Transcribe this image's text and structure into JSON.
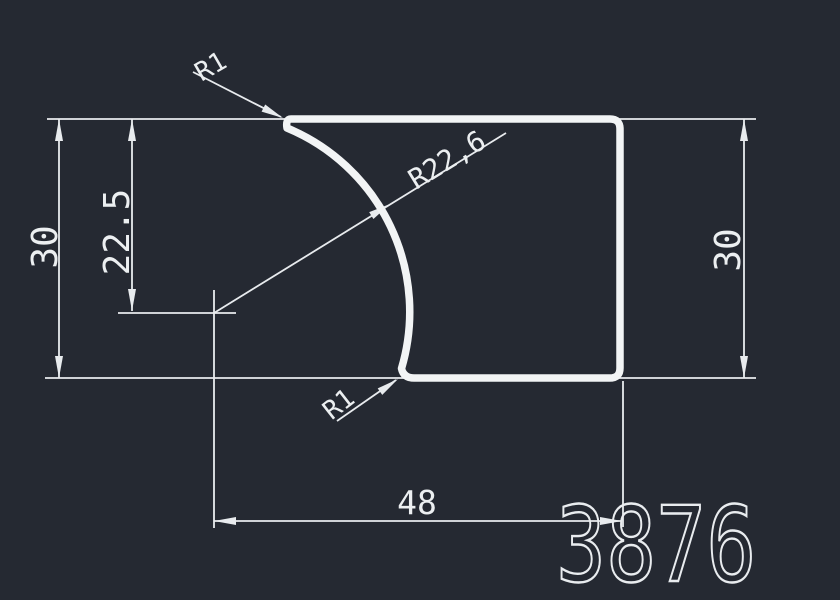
{
  "app": {
    "background_color": "#252932",
    "line_color": "#e8ebee"
  },
  "drawing": {
    "part_number": "3876",
    "labels": {
      "radius_top": "R1",
      "radius_arc": "R22,6",
      "offset_height": "22.5",
      "height_left": "30",
      "height_right": "30",
      "radius_bottom": "R1",
      "width": "48"
    }
  }
}
